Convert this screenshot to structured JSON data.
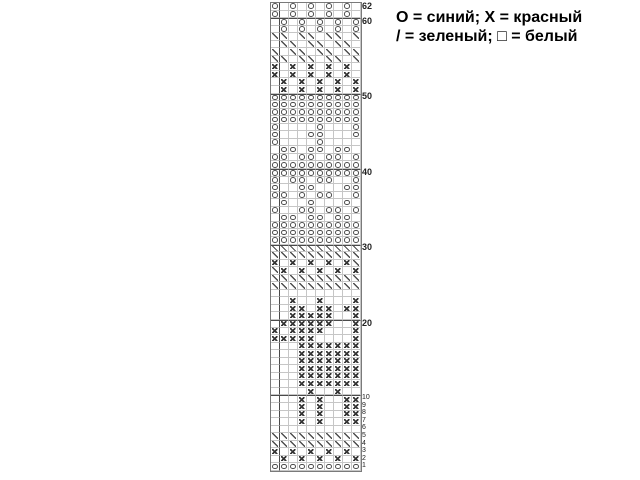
{
  "legend": {
    "line1": "О = синий; Х = красный",
    "line2": "/ = зеленый; □ = белый"
  },
  "colors": {
    "background": "#ffffff",
    "symbol": "#3a3a3a",
    "grid_line": "#c6c6c6",
    "grid_bold_line": "#4a4a4a",
    "grid_border": "#7a7a7a",
    "text": "#000000"
  },
  "chart_data": {
    "type": "table",
    "title": "Knitting colorwork chart (10 stitches wide, 62 rows)",
    "columns": 10,
    "rows_total": 62,
    "symbols": {
      "O": "синий (blue circle)",
      "X": "красный (red x)",
      "/": "зеленый (green slash)",
      ".": "белый (white / empty)"
    },
    "row_labels": [
      62,
      60,
      50,
      40,
      30,
      20,
      10,
      9,
      8,
      7,
      6,
      5,
      4,
      3,
      2,
      1
    ],
    "bold_row_boundaries": [
      60,
      50,
      40,
      30,
      20,
      10
    ],
    "bold_column_after": 1,
    "rows": [
      {
        "n": 62,
        "cells": "O.O.O.O.O."
      },
      {
        "n": 61,
        "cells": "O.O.O.O.O."
      },
      {
        "n": 60,
        "cells": ".O.O.O.O.O"
      },
      {
        "n": 59,
        "cells": ".O.O.O.O.O"
      },
      {
        "n": 58,
        "cells": "//.//.//./"
      },
      {
        "n": 57,
        "cells": ".//.//.//."
      },
      {
        "n": 56,
        "cells": "/.//.//.//"
      },
      {
        "n": 55,
        "cells": "//.//.//./"
      },
      {
        "n": 54,
        "cells": "X.X.X.X.X."
      },
      {
        "n": 53,
        "cells": "X.X.X.X.X."
      },
      {
        "n": 52,
        "cells": ".X.X.X.X.X"
      },
      {
        "n": 51,
        "cells": ".X.X.X.X.X"
      },
      {
        "n": 50,
        "cells": "OOOOOOOOOO"
      },
      {
        "n": 49,
        "cells": "OOOOOOOOOO"
      },
      {
        "n": 48,
        "cells": "OOOOOOOOOO"
      },
      {
        "n": 47,
        "cells": "OOOOOOOOOO"
      },
      {
        "n": 46,
        "cells": "O....O...O"
      },
      {
        "n": 45,
        "cells": "O...OO...O"
      },
      {
        "n": 44,
        "cells": "O....O...."
      },
      {
        "n": 43,
        "cells": ".OO.OO.OO."
      },
      {
        "n": 42,
        "cells": "OO.OO.OO.O"
      },
      {
        "n": 41,
        "cells": "OOOOOOOOOO"
      },
      {
        "n": 40,
        "cells": "OOOOOOOOOO"
      },
      {
        "n": 39,
        "cells": "O.OO.OO..O"
      },
      {
        "n": 38,
        "cells": "O..OO...OO"
      },
      {
        "n": 37,
        "cells": "OO.O.OO..O"
      },
      {
        "n": 36,
        "cells": ".O..O...O."
      },
      {
        "n": 35,
        "cells": "O..OO.OO.O"
      },
      {
        "n": 34,
        "cells": ".OO.OO.OO."
      },
      {
        "n": 33,
        "cells": "OOOOOOOOOO"
      },
      {
        "n": 32,
        "cells": "OOOOOOOOOO"
      },
      {
        "n": 31,
        "cells": "OOOOOOOOOO"
      },
      {
        "n": 30,
        "cells": "//////////"
      },
      {
        "n": 29,
        "cells": "//////////"
      },
      {
        "n": 28,
        "cells": "X.X.X.X.X/"
      },
      {
        "n": 27,
        "cells": "/X.X.X.X.X"
      },
      {
        "n": 26,
        "cells": "//////////"
      },
      {
        "n": 25,
        "cells": "//////////"
      },
      {
        "n": 24,
        "cells": ".........."
      },
      {
        "n": 23,
        "cells": "..X..X...X"
      },
      {
        "n": 22,
        "cells": "..XX.XX.XX"
      },
      {
        "n": 21,
        "cells": "..XXXXX..X"
      },
      {
        "n": 20,
        "cells": ".XXXXXX..X"
      },
      {
        "n": 19,
        "cells": "X.XXXX...X"
      },
      {
        "n": 18,
        "cells": "XXXXX....X"
      },
      {
        "n": 17,
        "cells": "...XXXXXXX"
      },
      {
        "n": 16,
        "cells": "...XXXXXXX"
      },
      {
        "n": 15,
        "cells": "...XXXXXXX"
      },
      {
        "n": 14,
        "cells": "...XXXXXXX"
      },
      {
        "n": 13,
        "cells": "...XXXXXXX"
      },
      {
        "n": 12,
        "cells": "...XXXXXXX"
      },
      {
        "n": 11,
        "cells": "....X..X.."
      },
      {
        "n": 10,
        "cells": "...X.X..XX"
      },
      {
        "n": 9,
        "cells": "...X.X..XX"
      },
      {
        "n": 8,
        "cells": "...X.X..XX"
      },
      {
        "n": 7,
        "cells": "...X.X..XX"
      },
      {
        "n": 6,
        "cells": ".........."
      },
      {
        "n": 5,
        "cells": "//////////"
      },
      {
        "n": 4,
        "cells": "//////////"
      },
      {
        "n": 3,
        "cells": "X.X.X.X.X."
      },
      {
        "n": 2,
        "cells": ".X.X.X.X.X"
      },
      {
        "n": 1,
        "cells": "OOOOOOOOOO"
      }
    ]
  }
}
